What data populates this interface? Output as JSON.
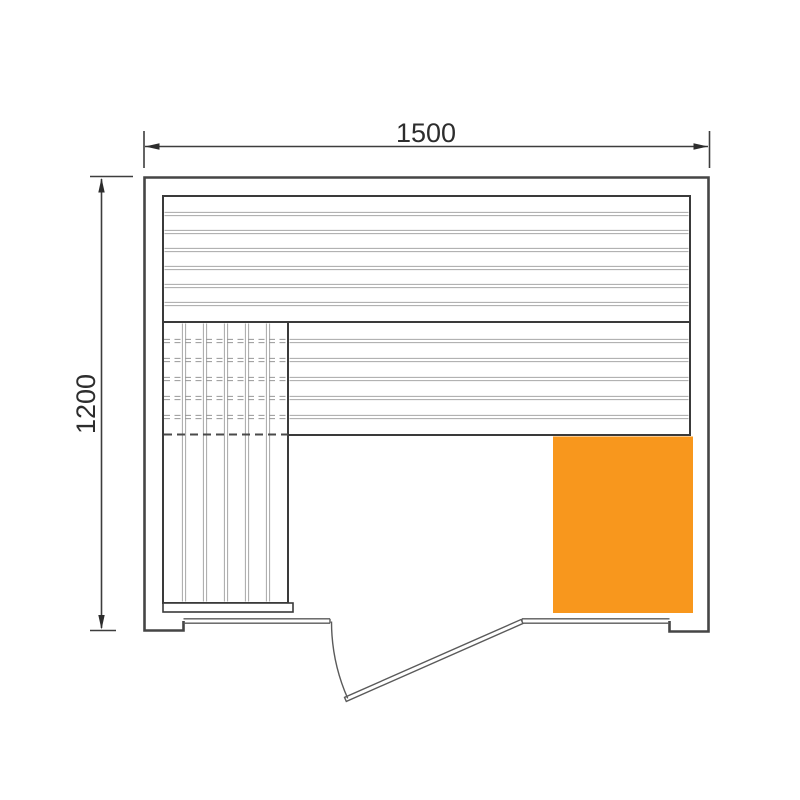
{
  "dimensions": {
    "width": {
      "label": "1500"
    },
    "depth": {
      "label": "1200"
    }
  },
  "colors": {
    "heater": "#F8971D"
  },
  "plan": {
    "upper_bench_boards": 7,
    "lower_bench_boards": 6,
    "side_bench_boards": 6,
    "door_present": true
  }
}
